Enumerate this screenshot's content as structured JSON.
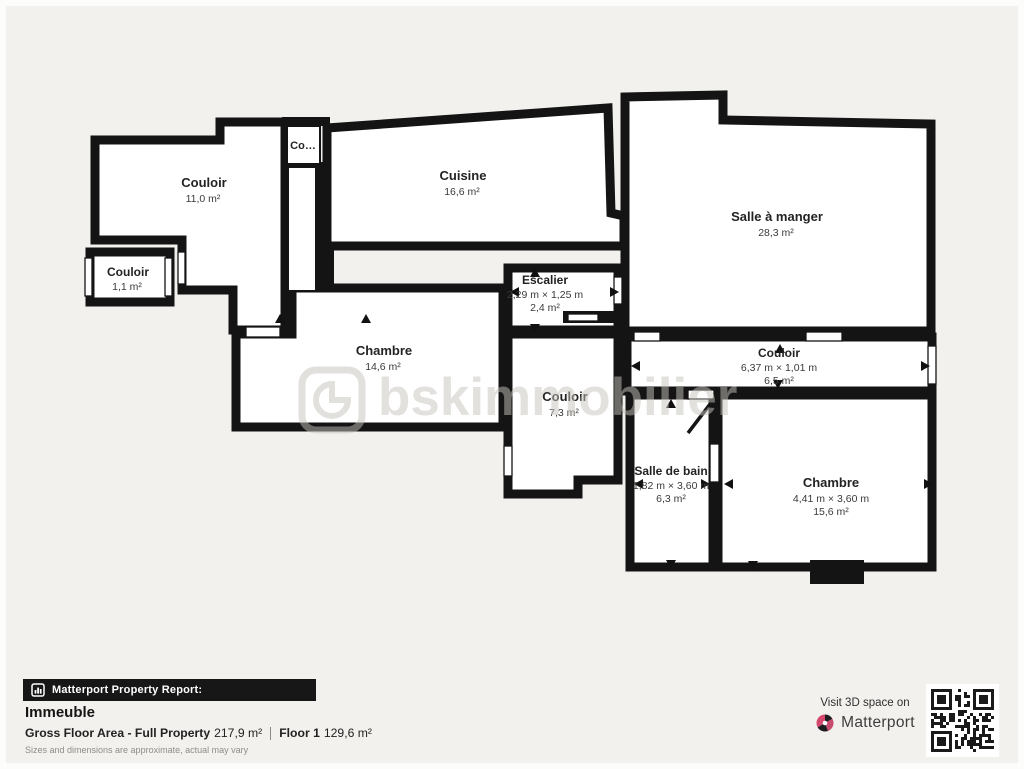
{
  "plan": {
    "rooms": {
      "couloir_main": {
        "name": "Couloir",
        "area": "11,0 m²"
      },
      "couloir_small": {
        "name": "Couloir",
        "area": "1,1 m²"
      },
      "closet": {
        "name": "Co…"
      },
      "cuisine": {
        "name": "Cuisine",
        "area": "16,6 m²"
      },
      "salle_a_manger": {
        "name": "Salle à manger",
        "area": "28,3 m²"
      },
      "escalier": {
        "name": "Escalier",
        "dims": "2,29 m × 1,25 m",
        "area": "2,4 m²"
      },
      "chambre_left": {
        "name": "Chambre",
        "area": "14,6 m²"
      },
      "couloir_mid": {
        "name": "Couloir",
        "area": "7,3 m²"
      },
      "couloir_long": {
        "name": "Couloir",
        "dims": "6,37 m × 1,01 m",
        "area": "6,5 m²"
      },
      "salle_de_bain": {
        "name": "Salle de bain",
        "dims": "1,82 m × 3,60 m",
        "area": "6,3 m²"
      },
      "chambre_right": {
        "name": "Chambre",
        "dims": "4,41 m × 3,60 m",
        "area": "15,6 m²"
      }
    },
    "watermark": "bskimmobilier"
  },
  "footer": {
    "report_label": "Matterport Property Report:",
    "property_name": "Immeuble",
    "gfa_label": "Gross Floor Area - Full Property",
    "gfa_value": "217,9 m²",
    "floor_label": "Floor 1",
    "floor_value": "129,6 m²",
    "disclaimer": "Sizes and dimensions are approximate, actual may vary"
  },
  "cta": {
    "visit_label": "Visit 3D space on",
    "brand": "Matterport"
  },
  "colors": {
    "wall": "#141414",
    "room": "#ffffff",
    "background": "#f3f1ee",
    "accent_red": "#c84b6e",
    "bar_black": "#171717"
  }
}
